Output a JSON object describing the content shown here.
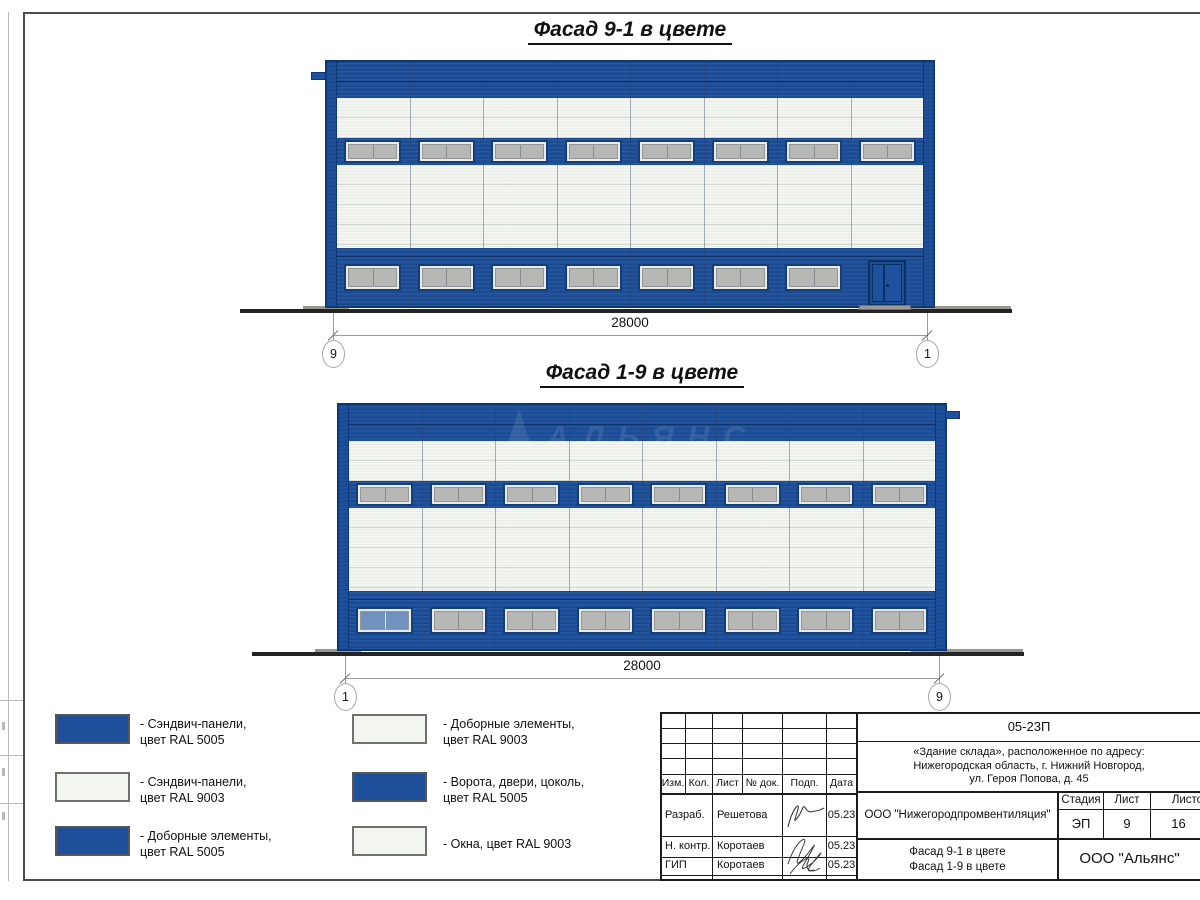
{
  "facades": [
    {
      "title": "Фасад 9-1 в цвете",
      "dimension": "28000",
      "axis_left": "9",
      "axis_right": "1",
      "mid_windows": 8,
      "bottom_windows": 7,
      "has_door": true,
      "gutter_side": "left",
      "blue_window_index": -1,
      "watermark": ""
    },
    {
      "title": "Фасад 1-9 в цвете",
      "dimension": "28000",
      "axis_left": "1",
      "axis_right": "9",
      "mid_windows": 8,
      "bottom_windows": 8,
      "has_door": false,
      "gutter_side": "right",
      "blue_window_index": 0,
      "watermark": "АЛЬЯНС"
    }
  ],
  "legend": {
    "items": [
      {
        "swatch": "blue",
        "line1": "- Сэндвич-панели,",
        "line2": "цвет RAL 5005"
      },
      {
        "swatch": "white",
        "line1": "- Сэндвич-панели,",
        "line2": "цвет RAL 9003"
      },
      {
        "swatch": "blue",
        "line1": "- Доборные элементы,",
        "line2": "цвет RAL 5005"
      },
      {
        "swatch": "white",
        "line1": "- Доборные элементы,",
        "line2": "цвет RAL 9003"
      },
      {
        "swatch": "blue",
        "line1": "- Ворота, двери, цоколь,",
        "line2": "цвет RAL 5005"
      },
      {
        "swatch": "white",
        "line1": "- Окна, цвет RAL 9003",
        "line2": ""
      }
    ]
  },
  "titleblock": {
    "code": "05-23П",
    "address_line1": "«Здание склада», расположенное по адресу:",
    "address_line2": "Нижегородская область, г. Нижний Новгород,",
    "address_line3": "ул. Героя Попова, д. 45",
    "col_izm": "Изм.",
    "col_kol": "Кол.",
    "col_list": "Лист",
    "col_doc": "№ док.",
    "col_podp": "Подп.",
    "col_data": "Дата",
    "row1_role": "Разраб.",
    "row1_name": "Решетова",
    "row1_date": "05.23",
    "row2_role": "Н. контр.",
    "row2_name": "Коротаев",
    "row2_date": "05.23",
    "row3_role": "ГИП",
    "row3_name": "Коротаев",
    "row3_date": "05.23",
    "org": "ООО \"Нижегородпромвентиляция\"",
    "stage_label": "Стадия",
    "sheet_label": "Лист",
    "sheets_label": "Листов",
    "stage_value": "ЭП",
    "sheet_value": "9",
    "sheets_value": "16",
    "content_line1": "Фасад 9-1 в цвете",
    "content_line2": "Фасад 1-9 в цвете",
    "company": "ООО \"Альянс\""
  },
  "colors": {
    "ral5005": "#1d4f9a",
    "ral9003": "#f3f5f0",
    "frame_blue": "#0d3874",
    "ground": "#242424"
  }
}
